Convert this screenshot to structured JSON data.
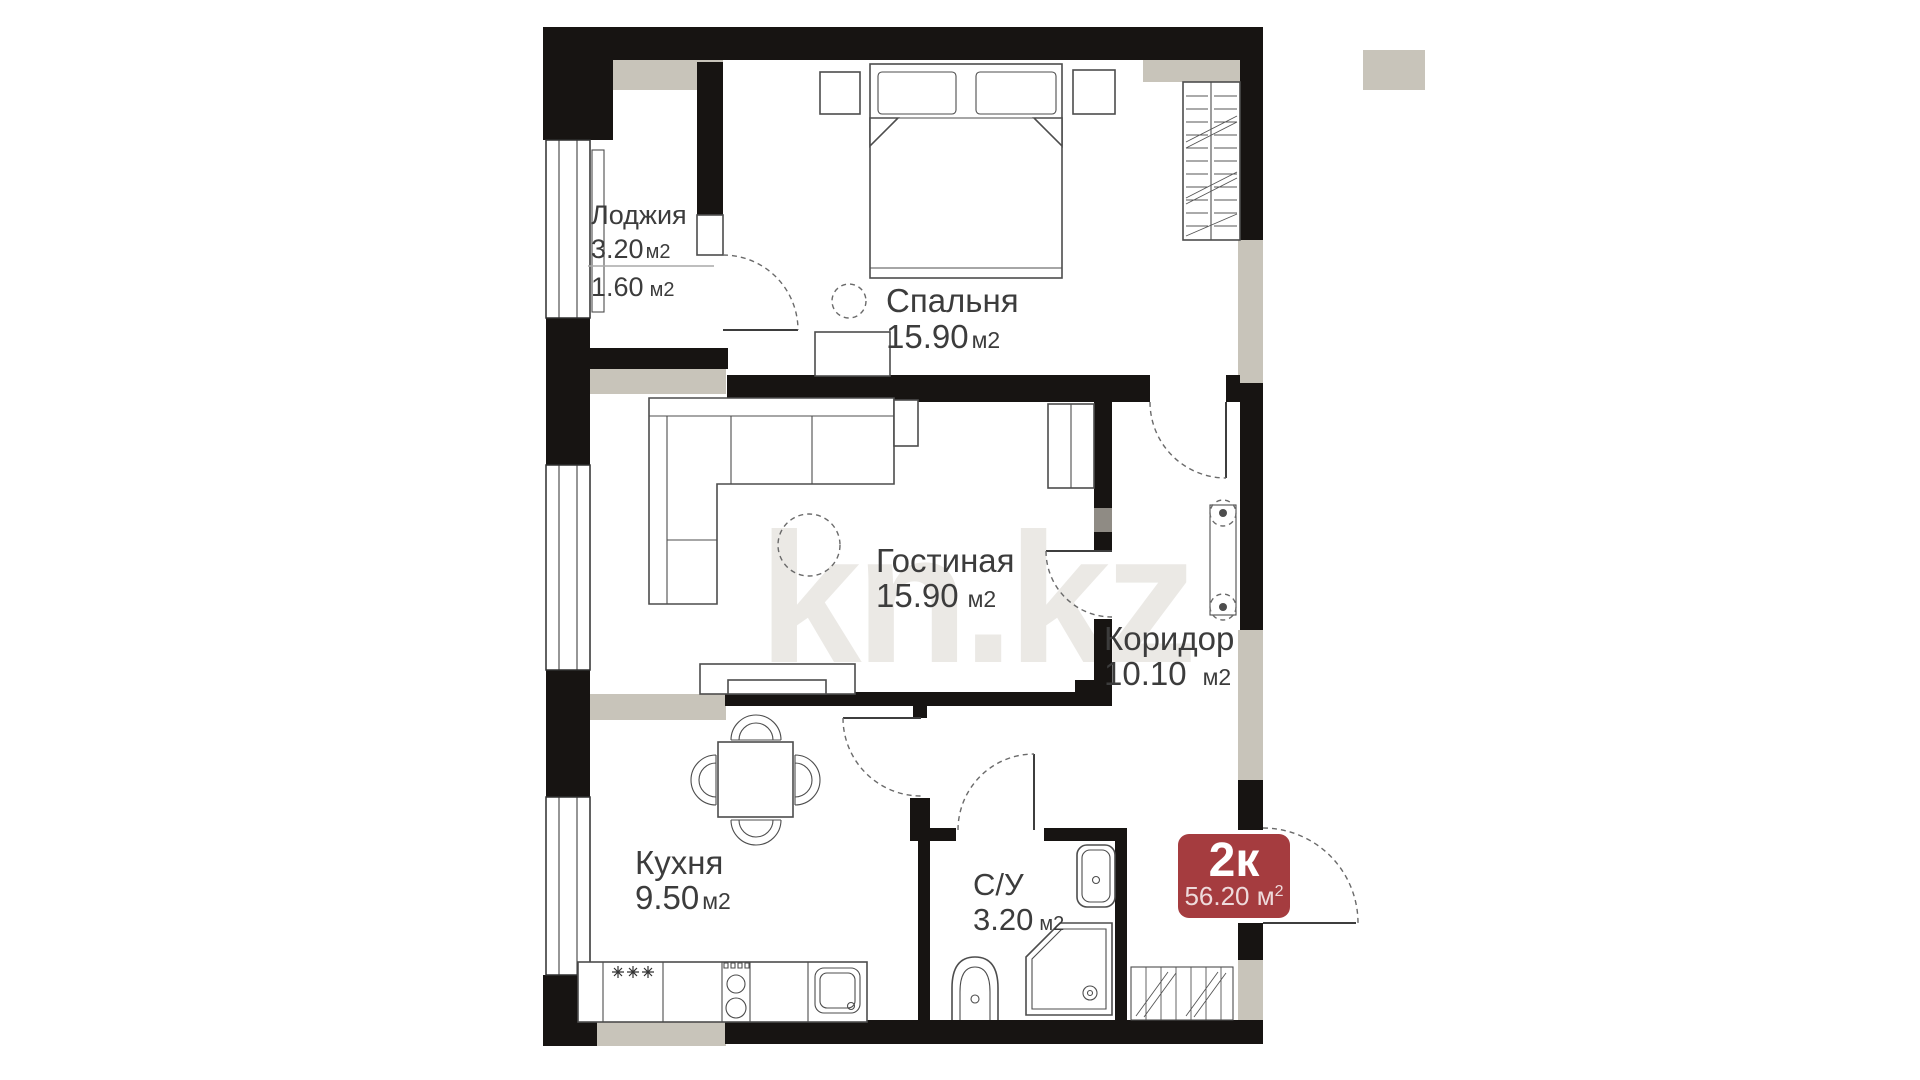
{
  "plan": {
    "watermark": "kn.kz",
    "badge": {
      "label": "2к",
      "area": "56.20",
      "unit": " м",
      "sup": "2"
    },
    "rooms": {
      "loggia": {
        "name": "Лоджия",
        "area_total": "3.20",
        "unit_total": "м2",
        "area_reduced": "1.60",
        "unit_reduced": "м2"
      },
      "bedroom": {
        "name": "Спальня",
        "area": "15.90",
        "unit": "м2"
      },
      "living": {
        "name": "Гостиная",
        "area": "15.90",
        "unit": "м2"
      },
      "corridor": {
        "name": "Коридор",
        "area": "10.10",
        "unit": "м2"
      },
      "kitchen": {
        "name": "Кухня",
        "area": "9.50",
        "unit": "м2"
      },
      "bathroom": {
        "name": "С/У",
        "area": "3.20",
        "unit": "м2"
      }
    },
    "colors": {
      "wall": "#171412",
      "lining": "#c8c4ba",
      "badge": "#a53c3f",
      "label": "#3c3c3c",
      "watermark": "#ebe9e5"
    }
  }
}
